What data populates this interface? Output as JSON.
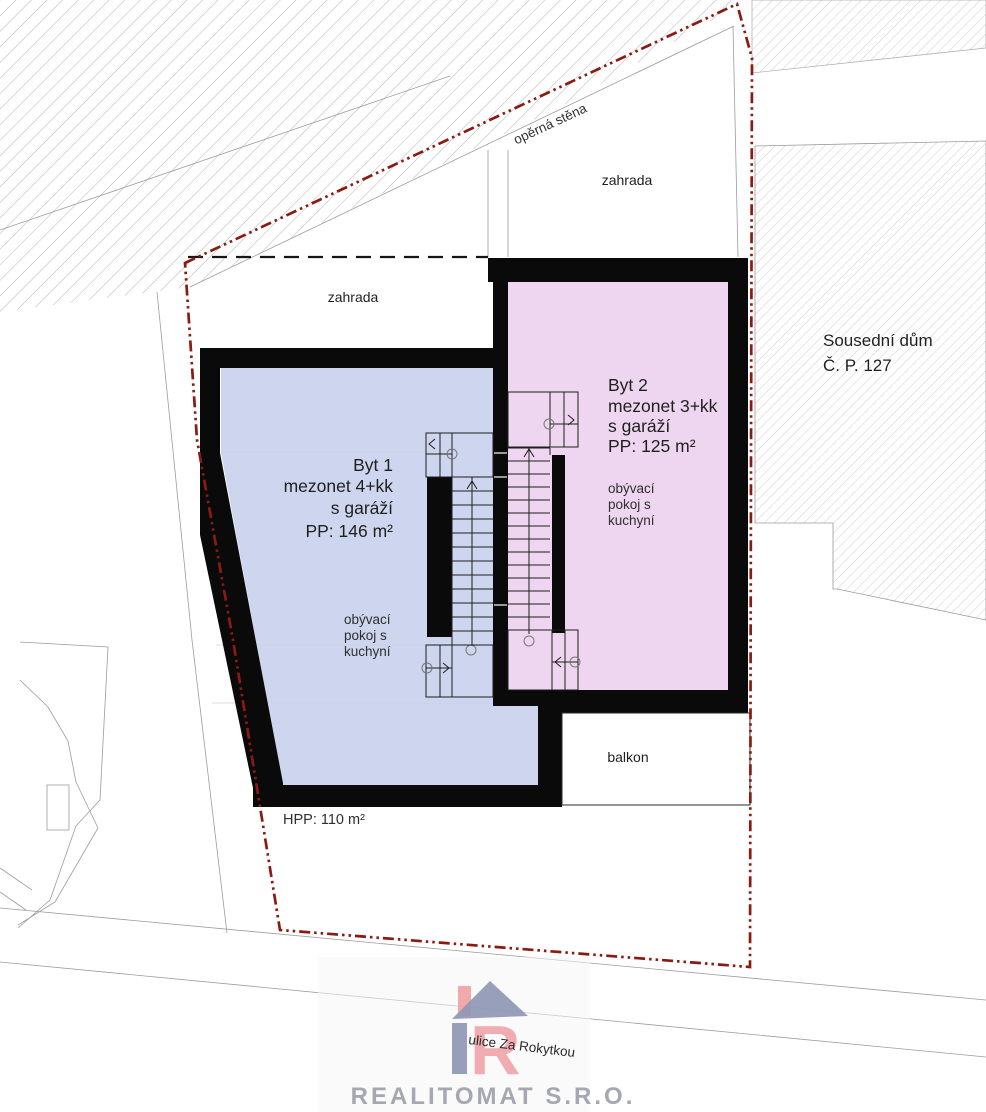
{
  "plan": {
    "site": {
      "garden_left": "zahrada",
      "garden_right": "zahrada",
      "retaining_wall": "opěrná stěna",
      "neighbor_house_line1": "Sousední dům",
      "neighbor_house_line2": "Č. P. 127",
      "balcony": "balkon",
      "gross_floor_area": "HPP: 110 m²"
    },
    "apartments": [
      {
        "name": "Byt 1",
        "layout": "mezonet 4+kk",
        "garage": "s garáží",
        "area": "PP: 146 m²",
        "living_room_lines": [
          "obývací",
          "pokoj s",
          "kuchyní"
        ]
      },
      {
        "name": "Byt 2",
        "layout": "mezonet 3+kk",
        "garage": "s garáží",
        "area": "PP: 125 m²",
        "living_room_lines": [
          "obývací",
          "pokoj s",
          "kuchyní"
        ]
      }
    ],
    "colors": {
      "apartment1_fill": "#cdd6ee",
      "apartment2_fill": "#efd6f0",
      "boundary_line": "#8a1a12",
      "wall": "#0a0a0a"
    }
  },
  "watermark": {
    "logo_letter": "R",
    "street": "ulice Za Rokytkou",
    "company": "REALITOMAT S.R.O."
  }
}
